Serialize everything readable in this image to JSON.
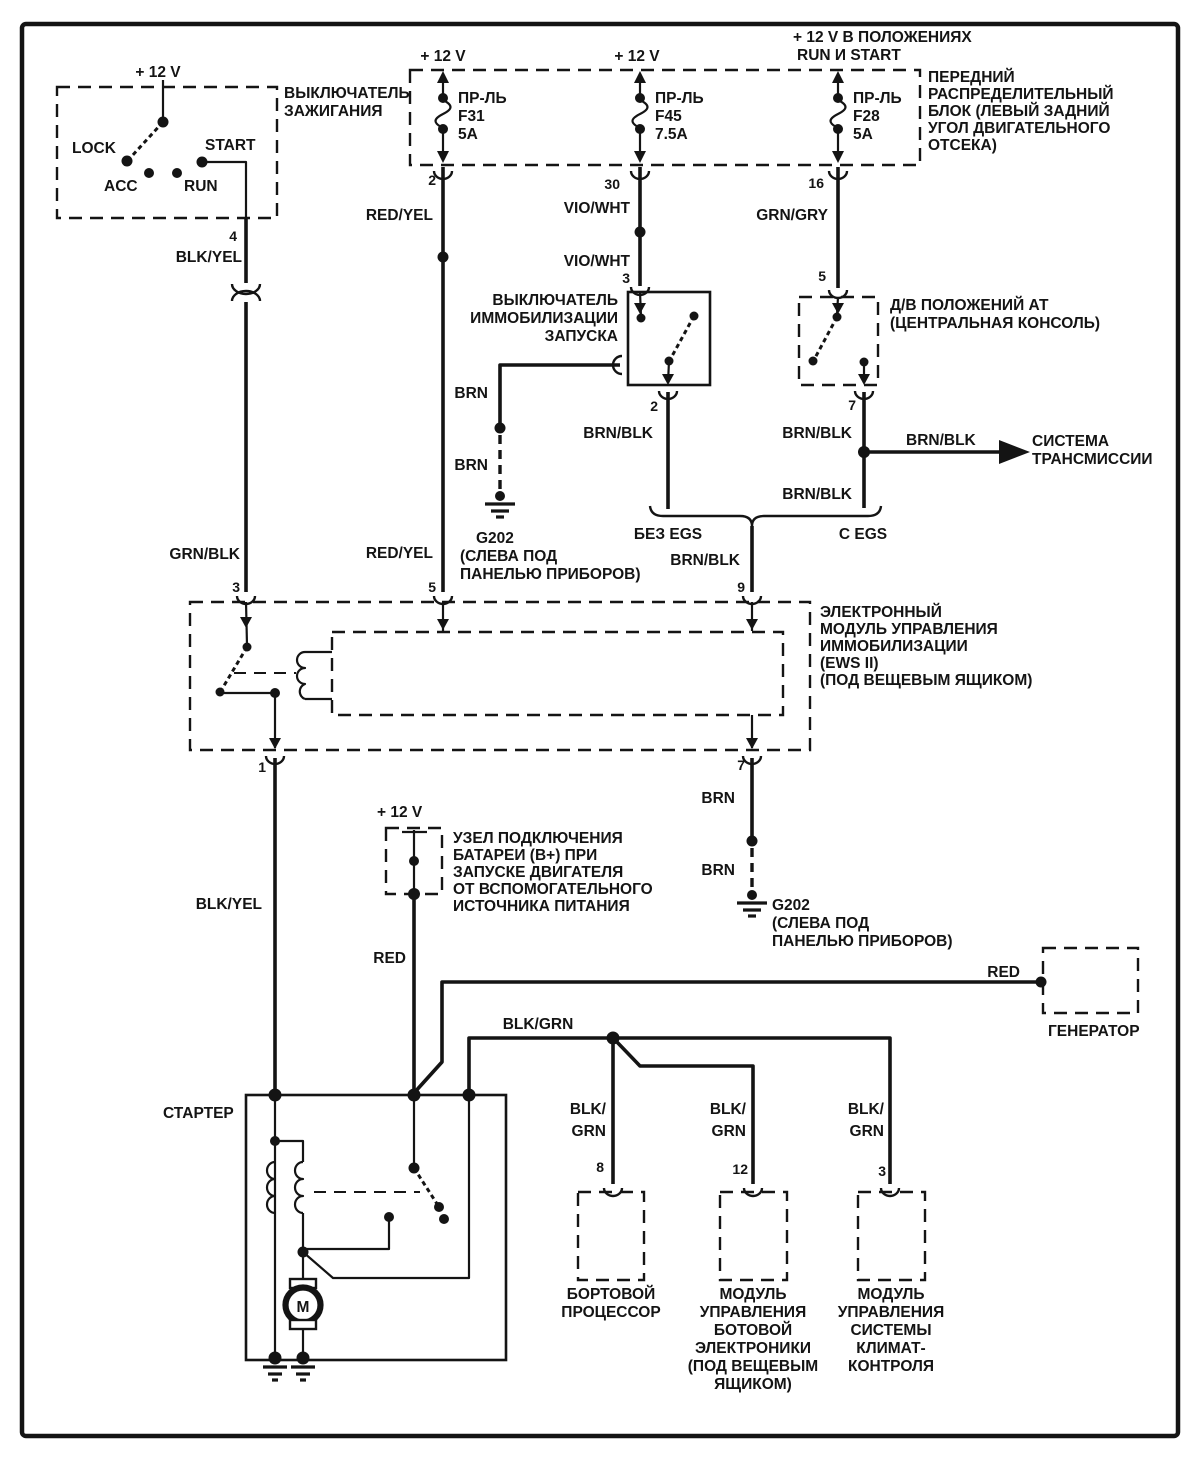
{
  "power": {
    "v12": "+ 12 V",
    "v12_run_start_1": "+ 12 V  В ПОЛОЖЕНИЯХ",
    "v12_run_start_2": "RUN И START"
  },
  "wires": {
    "blk_yel": "BLK/YEL",
    "grn_blk": "GRN/BLK",
    "red_yel": "RED/YEL",
    "vio_wht": "VIO/WHT",
    "grn_gry": "GRN/GRY",
    "brn": "BRN",
    "brn_blk": "BRN/BLK",
    "red": "RED",
    "blk_grn": "BLK/GRN",
    "blk": "BLK/",
    "grn": "GRN"
  },
  "ignition_switch": {
    "title": [
      "ВЫКЛЮЧАТЕЛЬ",
      "ЗАЖИГАНИЯ"
    ],
    "positions": {
      "lock": "LOCK",
      "acc": "ACC",
      "run": "RUN",
      "start": "START"
    },
    "pin_out": "4"
  },
  "fuse_box": {
    "label": [
      "ПЕРЕДНИЙ",
      "РАСПРЕДЕЛИТЕЛЬНЫЙ",
      "БЛОК (ЛЕВЫЙ ЗАДНИЙ",
      "УГОЛ ДВИГАТЕЛЬНОГО",
      "ОТСЕКА)"
    ],
    "fuses": [
      {
        "name": "ПР-ЛЬ",
        "id": "F31",
        "rating": "5A",
        "pin": "2"
      },
      {
        "name": "ПР-ЛЬ",
        "id": "F45",
        "rating": "7.5A",
        "pin": "30"
      },
      {
        "name": "ПР-ЛЬ",
        "id": "F28",
        "rating": "5A",
        "pin": "16"
      }
    ]
  },
  "immobilizer_switch": {
    "title": [
      "ВЫКЛЮЧАТЕЛЬ",
      "ИММОБИЛИЗАЦИИ",
      "ЗАПУСКА"
    ],
    "pin_in": "3",
    "pin_out": "2"
  },
  "at_switch": {
    "title": [
      "Д/В ПОЛОЖЕНИЙ АТ",
      "(ЦЕНТРАЛЬНАЯ КОНСОЛЬ)"
    ],
    "pin_in": "5",
    "pin_out": "7"
  },
  "transmission": {
    "label": [
      "СИСТЕМА",
      "ТРАНСМИССИИ"
    ]
  },
  "egs": {
    "without": "БЕЗ EGS",
    "with": "C EGS",
    "pin": "9"
  },
  "ews": {
    "label": [
      "ЭЛЕКТРОННЫЙ",
      "МОДУЛЬ УПРАВЛЕНИЯ",
      "ИММОБИЛИЗАЦИИ",
      "(EWS II)",
      "(ПОД ВЕЩЕВЫМ ЯЩИКОМ)"
    ],
    "pin_3": "3",
    "pin_5": "5",
    "pin_9": "9",
    "pin_1": "1",
    "pin_7": "7"
  },
  "ground_g202_left": {
    "label": [
      "G202",
      "(СЛЕВА ПОД",
      "ПАНЕЛЬЮ ПРИБОРОВ)"
    ]
  },
  "ground_g202_right": {
    "label": [
      "G202",
      "(СЛЕВА ПОД",
      "ПАНЕЛЬЮ ПРИБОРОВ)"
    ]
  },
  "battery_node": {
    "label": [
      "УЗЕЛ ПОДКЛЮЧЕНИЯ",
      "БАТАРЕИ (B+) ПРИ",
      "ЗАПУСКЕ ДВИГАТЕЛЯ",
      "ОТ ВСПОМОГАТЕЛЬНОГО",
      "ИСТОЧНИКА ПИТАНИЯ"
    ]
  },
  "generator": {
    "label": "ГЕНЕРАТОР"
  },
  "starter": {
    "label": "СТАРТЕР",
    "motor": "M"
  },
  "modules": [
    {
      "pin": "8",
      "label": [
        "БОРТОВОЙ",
        "ПРОЦЕССОР"
      ]
    },
    {
      "pin": "12",
      "label": [
        "МОДУЛЬ",
        "УПРАВЛЕНИЯ",
        "БОТОВОЙ",
        "ЭЛЕКТРОНИКИ",
        "(ПОД ВЕЩЕВЫМ",
        "ЯЩИКОМ)"
      ]
    },
    {
      "pin": "3",
      "label": [
        "МОДУЛЬ",
        "УПРАВЛЕНИЯ",
        "СИСТЕМЫ",
        "КЛИМАТ-",
        "КОНТРОЛЯ"
      ]
    }
  ]
}
